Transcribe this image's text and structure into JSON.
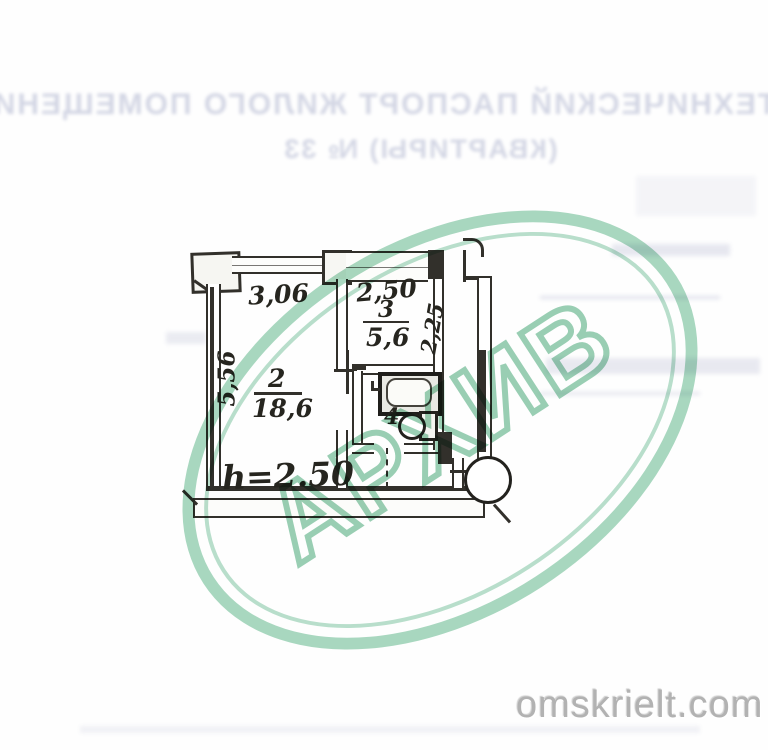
{
  "document": {
    "kind": "scanned technical passport floor plan",
    "bleed_header": {
      "line1": "ТЕХНИЧЕСКИЙ ПАСПОРТ ЖИЛОГО ПОМЕЩЕНИ",
      "line2": "(КВАРТИРЫ) № 33"
    },
    "watermark": {
      "text": "АРХИВ",
      "color": "#94ceb0"
    },
    "credit": "omskrielt.com"
  },
  "plan": {
    "line_color": "#32302b",
    "ceiling_height_label": "h=2.50",
    "dimensions": {
      "room2_width": "3,06",
      "room2_depth": "5,56",
      "room3_width": "2,50",
      "room3_depth": "2,25"
    },
    "rooms": [
      {
        "number": "2",
        "area": "18,6"
      },
      {
        "number": "3",
        "area": "5,6"
      },
      {
        "number": "4",
        "area": ""
      }
    ]
  }
}
